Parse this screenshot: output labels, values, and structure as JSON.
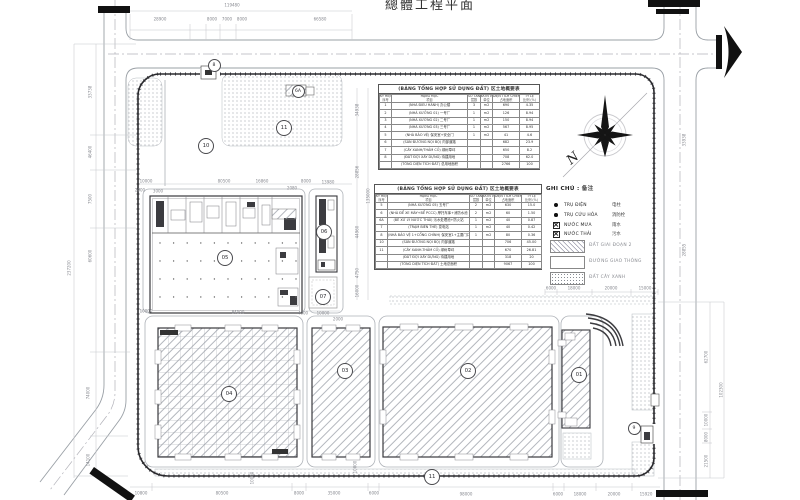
{
  "title": {
    "text": "總體工程平面"
  },
  "compass": {
    "label": "N"
  },
  "tables": {
    "t1": {
      "title": "(BẢNG TỔNG HỢP SỬ DỤNG ĐẤT) 区土地概要表",
      "headers_vi": [
        "KÝ HIỆU",
        "HẠNG MỤC",
        "SỐ TẦNG",
        "ĐƠN VỊ",
        "DIỆN TÍCH CHIẾM ĐẤT",
        "TỶ LỆ"
      ],
      "headers_zh": [
        "序号",
        "项目",
        "层数",
        "单位",
        "占地面积",
        "比例 (%)"
      ],
      "rows": [
        [
          "1",
          "(NHÀ ĐIỀU HÀNH) 办公楼",
          "3",
          "m2",
          "690",
          "4.35"
        ],
        [
          "2",
          "(NHÀ XƯỞNG 01) 一号厂",
          "1",
          "m2",
          "126",
          "8.94"
        ],
        [
          "3",
          "(NHÀ XƯỞNG 02) 二号厂",
          "1",
          "m2",
          "150",
          "8.94"
        ],
        [
          "4",
          "(NHÀ XƯỞNG 03) 三号厂",
          "1",
          "m2",
          "567",
          "8.95"
        ],
        [
          "5",
          "(NHÀ BẢO VỆ) 保安室+安全门",
          "1",
          "m2",
          "41",
          "4.6"
        ],
        [
          "6",
          "(SÂN ĐƯỜNG NỘI BỘ) 内部道路",
          "",
          "",
          "682",
          "23.9"
        ],
        [
          "7",
          "(CÂY XANH/THẢM CỎ) 绿树草坪",
          "",
          "",
          "650",
          "8.2"
        ],
        [
          "8",
          "(ĐẤT ĐỢI XÂY DỰNG) 待建用地",
          "",
          "",
          "708",
          "62.0"
        ],
        [
          "",
          "(TỔNG DIỆN TÍCH ĐẤT) 总用地面积",
          "",
          "",
          "2766",
          "100"
        ]
      ]
    },
    "t2": {
      "title": "(BẢNG TỔNG HỢP SỬ DỤNG ĐẤT) 区土地概要表",
      "headers_vi": [
        "KÝ HIỆU",
        "HẠNG MỤC",
        "SỐ TẦNG",
        "ĐƠN VỊ",
        "DIỆN TÍCH CHIẾM ĐẤT",
        "TỶ LỆ"
      ],
      "headers_zh": [
        "序号",
        "项目",
        "层数",
        "单位",
        "占地面积",
        "比例 (%)"
      ],
      "rows": [
        [
          "5",
          "(NHÀ XƯỞNG 05) 五号厂",
          "2",
          "m2",
          "630",
          "15.0"
        ],
        [
          "6",
          "(NHÀ ĐỂ XE MÁY+BỂ PCCC) 摩托车库+消防水池",
          "2",
          "m2",
          "60",
          "1.50"
        ],
        [
          "6A",
          "(BỂ XỬ LÝ NƯỚC THẢI) 污水处理池+防火站",
          "1",
          "m2",
          "40",
          "0.87"
        ],
        [
          "7",
          "(TRẠM BIẾN THẾ) 变电站",
          "1",
          "m2",
          "40",
          "0.42"
        ],
        [
          "8",
          "(NHÀ BẢO VỆ 1+CỔNG CHÍNH) 保安室1+主要门口",
          "1",
          "m2",
          "80",
          "0.36"
        ],
        [
          "10",
          "(SÂN ĐƯỜNG NỘI BỘ) 内部道路",
          "",
          "",
          "706",
          "45.00"
        ],
        [
          "11",
          "(CÂY XANH-THẢM CỎ) 绿树草坪",
          "",
          "",
          "670",
          "26.81"
        ],
        [
          "",
          "(ĐẤT ĐỢI XÂY DỰNG) 待建用地",
          "",
          "",
          "318",
          "20"
        ],
        [
          "",
          "(TỔNG DIỆN TÍCH ĐẤT) 土地总面积",
          "",
          "",
          "9067",
          "100"
        ]
      ]
    }
  },
  "legend": {
    "title_vi": "GHI CHÚ :",
    "title_zh": "备注",
    "symbols": [
      {
        "icon": "dot-large",
        "vi": "TRỤ ĐIỆN",
        "zh": "电柱"
      },
      {
        "icon": "dot-small",
        "vi": "TRỤ CỨU HỎA",
        "zh": "消防栓"
      },
      {
        "icon": "box-x",
        "vi": "NƯỚC MƯA",
        "zh": "雨水"
      },
      {
        "icon": "box-x",
        "vi": "NƯỚC THẢI",
        "zh": "污水"
      }
    ],
    "areas": [
      {
        "pattern": "hatch",
        "label": "ĐẤT GIAI ĐOẠN 2"
      },
      {
        "pattern": "road",
        "label": "ĐƯỜNG GIAO THÔNG"
      },
      {
        "pattern": "stipple",
        "label": "ĐẤT CÂY XANH"
      }
    ]
  },
  "plan": {
    "labels": [
      {
        "t": "8",
        "x": 213,
        "y": 64,
        "s": "small"
      },
      {
        "t": "6A",
        "x": 297,
        "y": 90,
        "s": "small"
      },
      {
        "t": "11",
        "x": 283,
        "y": 127,
        "s": "big"
      },
      {
        "t": "10",
        "x": 205,
        "y": 145,
        "s": "big"
      },
      {
        "t": "05",
        "x": 224,
        "y": 257,
        "s": "big"
      },
      {
        "t": "06",
        "x": 323,
        "y": 231,
        "s": "big"
      },
      {
        "t": "07",
        "x": 322,
        "y": 296,
        "s": "big"
      },
      {
        "t": "04",
        "x": 228,
        "y": 393,
        "s": "big"
      },
      {
        "t": "03",
        "x": 344,
        "y": 370,
        "s": "big"
      },
      {
        "t": "02",
        "x": 467,
        "y": 370,
        "s": "big"
      },
      {
        "t": "01",
        "x": 578,
        "y": 374,
        "s": "big"
      },
      {
        "t": "9",
        "x": 633,
        "y": 427,
        "s": "small"
      },
      {
        "t": "11",
        "x": 431,
        "y": 476,
        "s": "big"
      }
    ],
    "dims": [
      {
        "t": "119480",
        "x": 232,
        "y": 5,
        "r": 0
      },
      {
        "t": "28900",
        "x": 160,
        "y": 19,
        "r": 0
      },
      {
        "t": "8000",
        "x": 212,
        "y": 19,
        "r": 0
      },
      {
        "t": "7000",
        "x": 227,
        "y": 19,
        "r": 0
      },
      {
        "t": "8000",
        "x": 242,
        "y": 19,
        "r": 0
      },
      {
        "t": "66580",
        "x": 320,
        "y": 19,
        "r": 0
      },
      {
        "t": "33738",
        "x": 90,
        "y": 92,
        "r": 1
      },
      {
        "t": "46400",
        "x": 90,
        "y": 152,
        "r": 1
      },
      {
        "t": "7500",
        "x": 90,
        "y": 199,
        "r": 1
      },
      {
        "t": "60600",
        "x": 90,
        "y": 256,
        "r": 1
      },
      {
        "t": "74000",
        "x": 88,
        "y": 393,
        "r": 1
      },
      {
        "t": "14100",
        "x": 88,
        "y": 460,
        "r": 1
      },
      {
        "t": "237200",
        "x": 69,
        "y": 268,
        "r": 1
      },
      {
        "t": "62700",
        "x": 706,
        "y": 357,
        "r": 1
      },
      {
        "t": "10000",
        "x": 706,
        "y": 420,
        "r": 1
      },
      {
        "t": "8000",
        "x": 706,
        "y": 437,
        "r": 1
      },
      {
        "t": "21500",
        "x": 706,
        "y": 461,
        "r": 1
      },
      {
        "t": "102300",
        "x": 721,
        "y": 390,
        "r": 1
      },
      {
        "t": "33938",
        "x": 684,
        "y": 140,
        "r": 1
      },
      {
        "t": "28855",
        "x": 684,
        "y": 250,
        "r": 1
      },
      {
        "t": "10800",
        "x": 141,
        "y": 493,
        "r": 0
      },
      {
        "t": "80500",
        "x": 222,
        "y": 493,
        "r": 0
      },
      {
        "t": "8000",
        "x": 299,
        "y": 493,
        "r": 0
      },
      {
        "t": "35000",
        "x": 334,
        "y": 493,
        "r": 0
      },
      {
        "t": "6000",
        "x": 374,
        "y": 493,
        "r": 0
      },
      {
        "t": "98000",
        "x": 466,
        "y": 494,
        "r": 0
      },
      {
        "t": "6000",
        "x": 558,
        "y": 494,
        "r": 0
      },
      {
        "t": "18000",
        "x": 580,
        "y": 494,
        "r": 0
      },
      {
        "t": "20000",
        "x": 614,
        "y": 494,
        "r": 0
      },
      {
        "t": "15920",
        "x": 646,
        "y": 494,
        "r": 0
      },
      {
        "t": "6000",
        "x": 551,
        "y": 288,
        "r": 0
      },
      {
        "t": "18000",
        "x": 574,
        "y": 288,
        "r": 0
      },
      {
        "t": "20000",
        "x": 611,
        "y": 288,
        "r": 0
      },
      {
        "t": "15000",
        "x": 645,
        "y": 288,
        "r": 0
      },
      {
        "t": "10000",
        "x": 146,
        "y": 181,
        "r": 0
      },
      {
        "t": "2000",
        "x": 140,
        "y": 190,
        "r": 0
      },
      {
        "t": "3000",
        "x": 158,
        "y": 191,
        "r": 0
      },
      {
        "t": "80500",
        "x": 224,
        "y": 181,
        "r": 0
      },
      {
        "t": "16860",
        "x": 262,
        "y": 181,
        "r": 0
      },
      {
        "t": "2080",
        "x": 292,
        "y": 188,
        "r": 0
      },
      {
        "t": "8000",
        "x": 306,
        "y": 181,
        "r": 0
      },
      {
        "t": "13980",
        "x": 328,
        "y": 182,
        "r": 0
      },
      {
        "t": "10000",
        "x": 146,
        "y": 311,
        "r": 0
      },
      {
        "t": "84500",
        "x": 238,
        "y": 312,
        "r": 0
      },
      {
        "t": "4000",
        "x": 303,
        "y": 313,
        "r": 0
      },
      {
        "t": "10000",
        "x": 323,
        "y": 313,
        "r": 0
      },
      {
        "t": "2000",
        "x": 338,
        "y": 319,
        "r": 0
      },
      {
        "t": "34938",
        "x": 357,
        "y": 110,
        "r": 1
      },
      {
        "t": "28856",
        "x": 357,
        "y": 172,
        "r": 1
      },
      {
        "t": "135000",
        "x": 368,
        "y": 196,
        "r": 1
      },
      {
        "t": "44960",
        "x": 357,
        "y": 232,
        "r": 1
      },
      {
        "t": "4750",
        "x": 357,
        "y": 273,
        "r": 1
      },
      {
        "t": "16000",
        "x": 357,
        "y": 291,
        "r": 1
      },
      {
        "t": "10000",
        "x": 252,
        "y": 478,
        "r": 1
      },
      {
        "t": "10000",
        "x": 355,
        "y": 467,
        "r": 1
      }
    ]
  }
}
